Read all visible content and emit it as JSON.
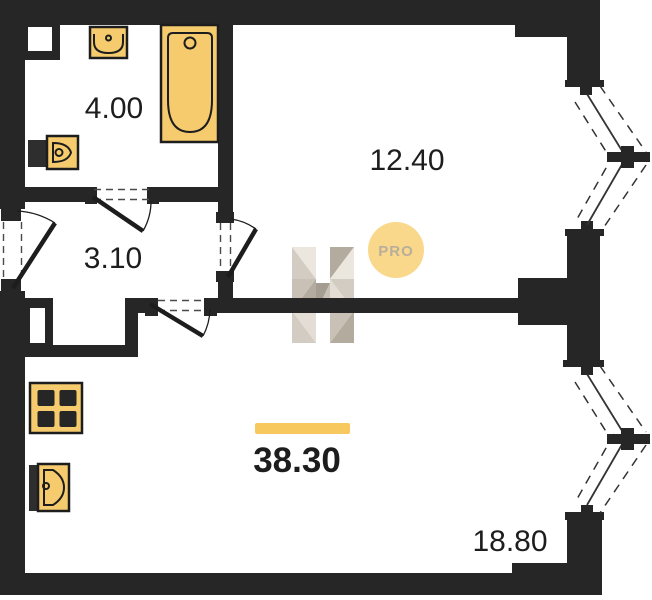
{
  "plan": {
    "room_areas": {
      "bathroom": "4.00",
      "hallway": "3.10",
      "room_top": "12.40",
      "room_bottom": "18.80"
    },
    "total_area": "38.30"
  },
  "watermark": {
    "badge": "PRO"
  },
  "colors": {
    "wall": "#262626",
    "fixture-fill": "#F5CB6E",
    "fixture-stroke": "#1d1d1d",
    "accent-bar": "#F7C85E",
    "badge-fill": "#F9D88C",
    "badge-text": "#B9AE9B",
    "label": "#1d1d1d",
    "wm-light": "#E8E2D9",
    "wm-light2": "#DFD8CE",
    "wm-mid": "#CCC4B8",
    "wm-mid2": "#C0B7AA",
    "wm-dark": "#A79D8F",
    "wm-darkest": "#968C7E"
  }
}
